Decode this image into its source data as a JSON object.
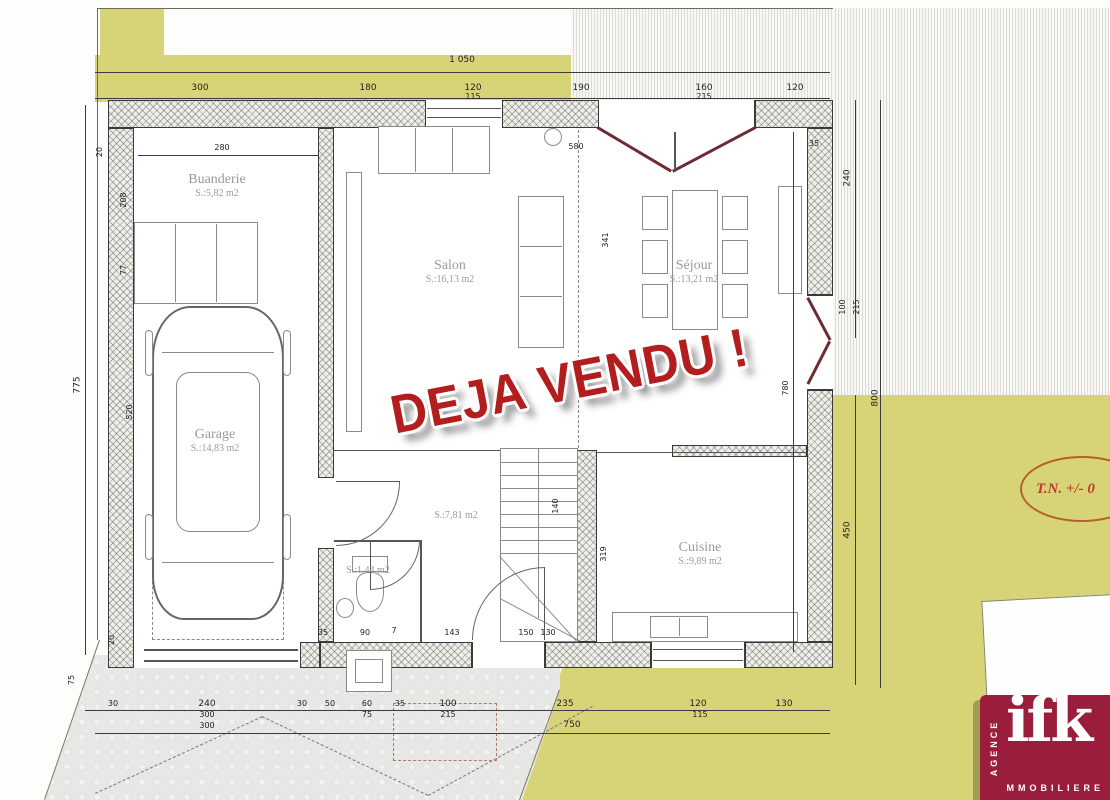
{
  "stamp": "DEJA VENDU !",
  "annotation": {
    "tn": "T.N. +/- 0"
  },
  "logo": {
    "name": "ifk",
    "agence": "AGENCE",
    "immobiliere": "MMOBILIERE"
  },
  "rooms": [
    {
      "id": "buanderie",
      "name": "Buanderie",
      "area": "S.:5,82 m2"
    },
    {
      "id": "garage",
      "name": "Garage",
      "area": "S.:14,83 m2"
    },
    {
      "id": "salon",
      "name": "Salon",
      "area": "S.:16,13 m2"
    },
    {
      "id": "sejour",
      "name": "Séjour",
      "area": "S.:13,21 m2"
    },
    {
      "id": "cuisine",
      "name": "Cuisine",
      "area": "S.:9,89 m2"
    },
    {
      "id": "hall",
      "name": "",
      "area": "S.:7,81 m2"
    },
    {
      "id": "wc",
      "name": "",
      "area": "S.:1,44 m2"
    }
  ],
  "dims": {
    "total_width": "1 050",
    "t1": "300",
    "t2": "180",
    "t3": "120",
    "t3s": "115",
    "t4": "190",
    "t5": "160",
    "t5s": "215",
    "t6": "120",
    "left_total": "775",
    "l1": "20",
    "l2": "280",
    "l3": "208",
    "l4": "77",
    "l5": "520",
    "l6": "20",
    "l7": "75",
    "r1": "240",
    "r2": "100",
    "r3": "215",
    "r4": "780",
    "r5": "450",
    "r6": "800",
    "r7": "35",
    "b1": "30",
    "b2": "240",
    "b3": "30",
    "b4": "50",
    "b5": "60",
    "b5s": "75",
    "b6": "35",
    "b7": "100",
    "b7s": "215",
    "b8": "235",
    "b9": "120",
    "b9s": "115",
    "b10": "130",
    "b_sub1": "300",
    "b_sub2": "300",
    "b_total": "750",
    "i1": "580",
    "i2": "341",
    "i3": "140",
    "i4": "319",
    "i5": "90",
    "i6": "7",
    "i7": "143",
    "i8": "150",
    "i9": "130",
    "i10": "35"
  }
}
